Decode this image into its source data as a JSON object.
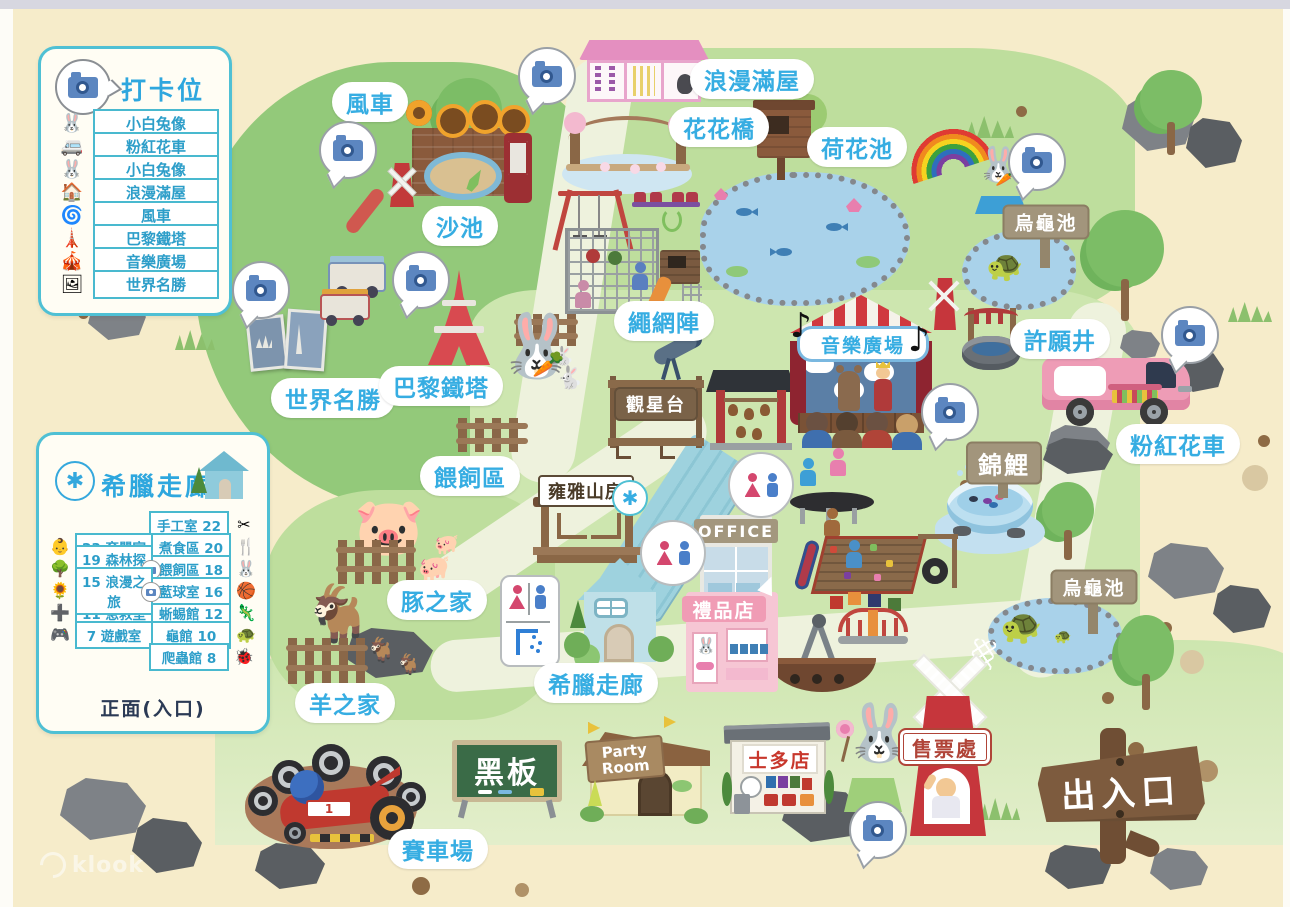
{
  "watermark": "klook",
  "colors": {
    "background": "#f6ecca",
    "grass_dark": "#93c97a",
    "grass_light": "#c8e3ab",
    "path": "#eef2dd",
    "label_blue": "#36ade2",
    "legend_border": "#4fc0d4",
    "wood_sign": "#a2957c",
    "red_accent": "#d0393f",
    "pink": "#ef9ab5"
  },
  "legend_checkin": {
    "title": "打卡位置",
    "items": [
      {
        "name": "rabbit-statue",
        "label": "小白兔像",
        "glyph": "🐰"
      },
      {
        "name": "pink-van",
        "label": "粉紅花車",
        "glyph": "🚐"
      },
      {
        "name": "rabbit-statue-2",
        "label": "小白兔像",
        "glyph": "🐰"
      },
      {
        "name": "romantic-house",
        "label": "浪漫滿屋",
        "glyph": "🏠"
      },
      {
        "name": "windmill",
        "label": "風車",
        "glyph": "🌀"
      },
      {
        "name": "eiffel-tower",
        "label": "巴黎鐵塔",
        "glyph": "🗼"
      },
      {
        "name": "music-plaza",
        "label": "音樂廣場",
        "glyph": "🎪"
      },
      {
        "name": "world-sights",
        "label": "世界名勝",
        "glyph": "🖼"
      }
    ]
  },
  "legend_greek": {
    "title": "希臘走廊",
    "marker": "✱",
    "footer": "正面(入口)",
    "left_rows": [
      {
        "label": "23 育嬰室",
        "glyph": "👶"
      },
      {
        "label": "19 森林探險",
        "glyph": "🌳",
        "camera": true
      },
      {
        "label": "15 浪漫之旅",
        "glyph": "🌻",
        "camera": true
      },
      {
        "label": "11 急救室",
        "glyph": "➕"
      },
      {
        "label": "7 遊戲室",
        "glyph": "🎮"
      }
    ],
    "right_rows": [
      {
        "label": "手工室 22",
        "glyph": "✂"
      },
      {
        "label": "煮食區 20",
        "glyph": "🍴"
      },
      {
        "label": "餵飼區 18",
        "glyph": "🐰"
      },
      {
        "label": "藍球室 16",
        "glyph": "🏀"
      },
      {
        "label": "蜥蜴館 12",
        "glyph": "🦎"
      },
      {
        "label": "龜館 10",
        "glyph": "🐢"
      },
      {
        "label": "爬蟲館 8",
        "glyph": "🐞"
      }
    ]
  },
  "places": {
    "windmill": "風車",
    "romantic_house": "浪漫滿屋",
    "flower_bridge": "花花橋",
    "lotus_pond": "荷花池",
    "sand_pit": "沙池",
    "rope_net": "繩網陣",
    "music_plaza": "音樂廣場",
    "wishing_well": "許願井",
    "world_sights": "世界名勝",
    "eiffel_tower": "巴黎鐵塔",
    "turtle_pond": "烏龜池",
    "pink_van": "粉紅花車",
    "stargazing_deck": "觀星台",
    "feeding_area": "餵飼區",
    "yongya_house": "雍雅山房",
    "koi": "錦鯉",
    "office": "OFFICE",
    "pig_home": "豚之家",
    "gift_shop": "禮品店",
    "greek_corridor": "希臘走廊",
    "goat_home": "羊之家",
    "blackboard": "黑板",
    "party_room": "Party Room",
    "store": "士多店",
    "ticket_office": "售票處",
    "entrance_exit": "出入口",
    "race_track": "賽車場"
  },
  "notes": {
    "music_note": "♪"
  }
}
